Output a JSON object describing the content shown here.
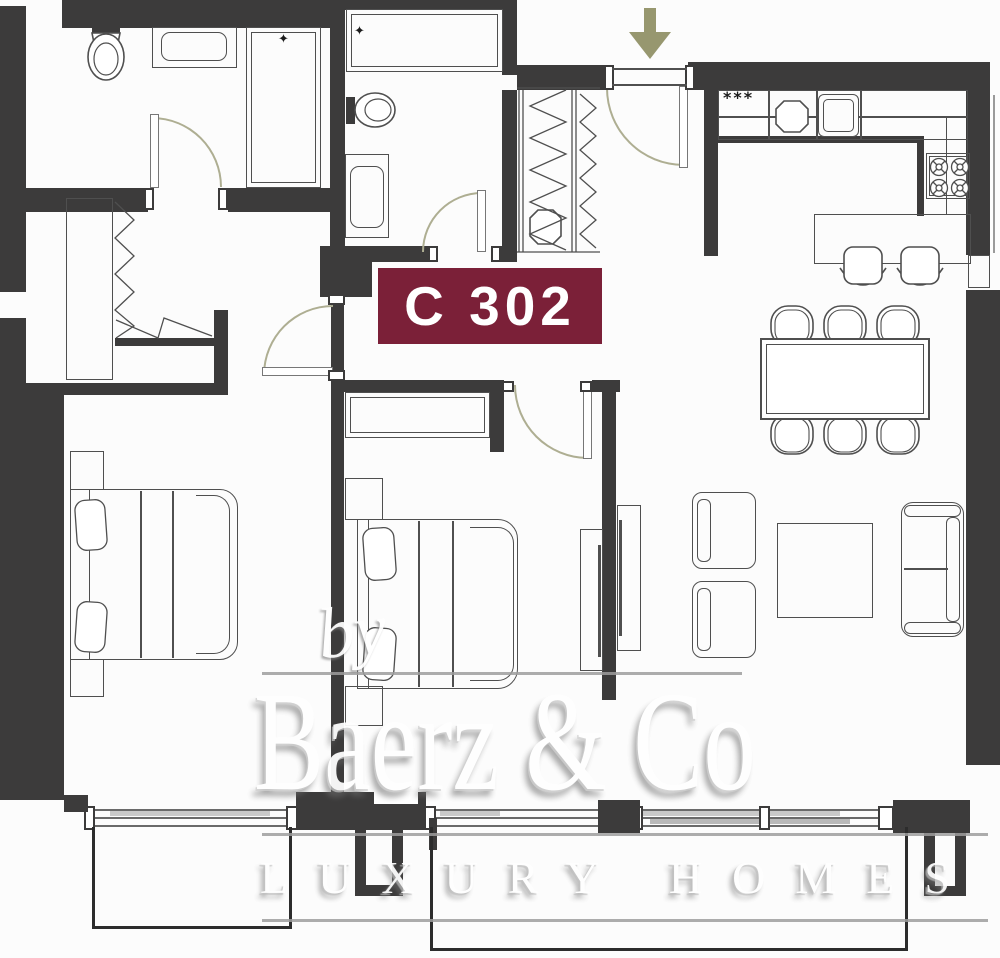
{
  "unit": {
    "label": "C 302"
  },
  "kitchen": {
    "hob_symbol": "***"
  },
  "bathroom": {
    "shower_marker": "✦"
  },
  "entry": {
    "direction_icon": "↓"
  },
  "watermark": {
    "prefix": "by",
    "brand": "Baerz & Co",
    "tagline": "LUXURY HOMES"
  },
  "colors": {
    "wall": "#3c3b3b",
    "line": "#4f4f4f",
    "door": "#aeae92",
    "arrow": "#97976f",
    "label_bg": "#7b2038",
    "label_text": "#ffffff",
    "rule": "#9d9d9d",
    "watermark": "#ffffff",
    "glass": "#c9c9c9"
  }
}
